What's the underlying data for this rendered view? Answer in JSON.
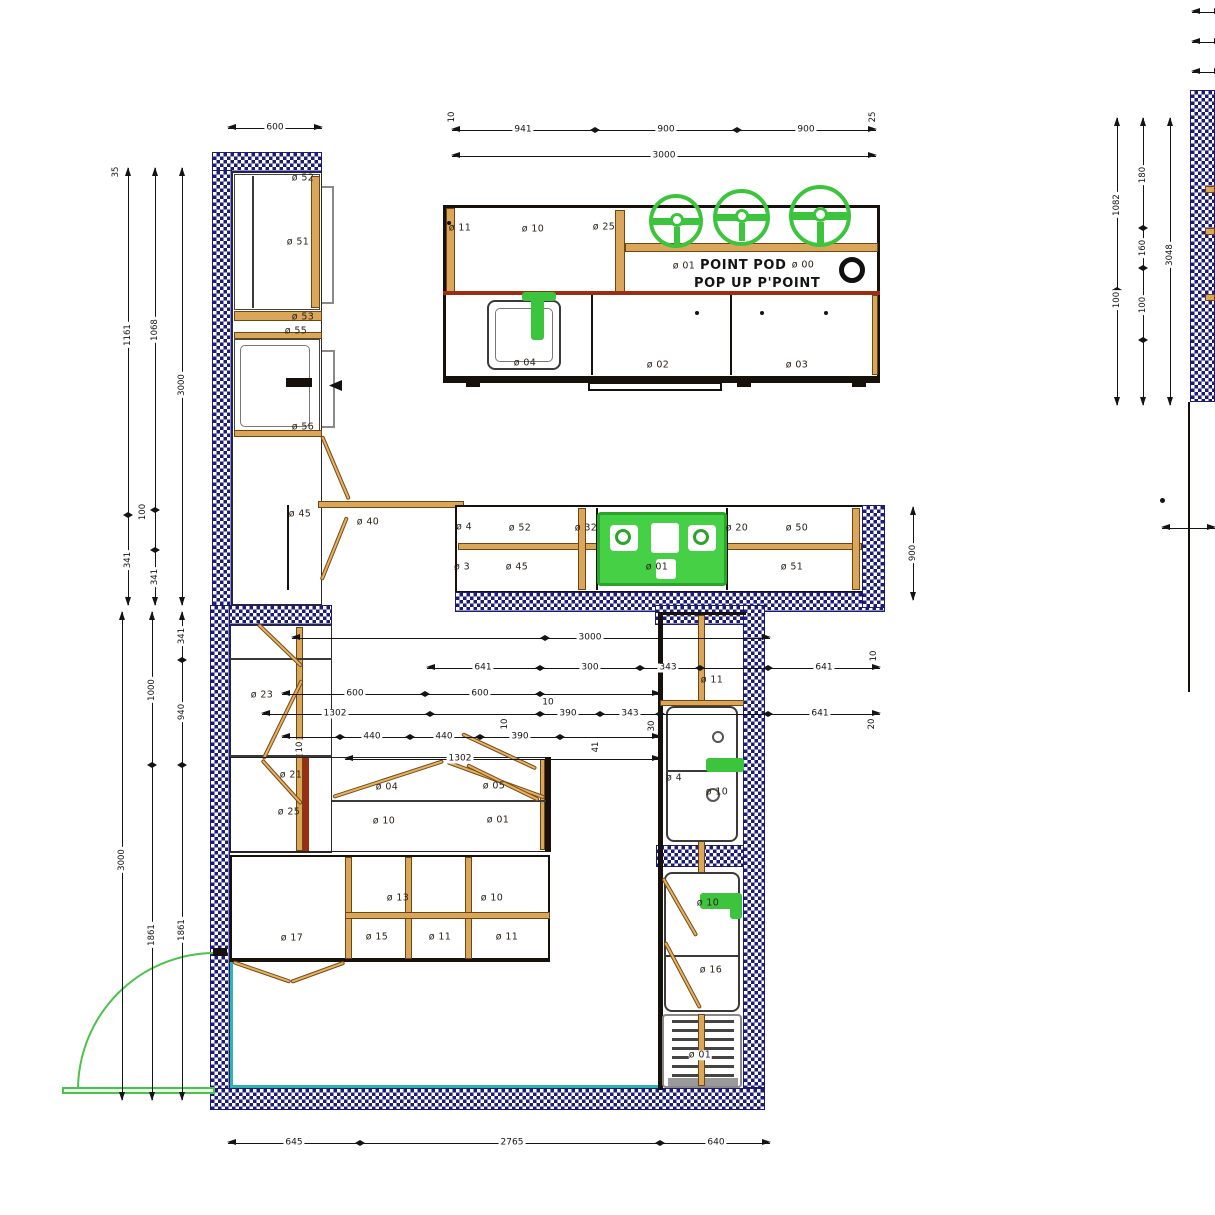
{
  "colors": {
    "wall_navy": "#1c1c78",
    "cabinet_tan": "#d9a65a",
    "outline_dark": "#17110b",
    "counter_red": "#9c2c12",
    "fixture_green": "#3cc43c",
    "door_teal": "#2fb3ae",
    "dim_black": "#141414"
  },
  "top_plan": {
    "dim_seg_left_end": "10",
    "dim_seg_1": "941",
    "dim_seg_2": "900",
    "dim_seg_3": "900",
    "dim_seg_right_end": "25",
    "dim_total": "3000",
    "label_left_edge": "ø 11",
    "label_cabinet": "ø 10",
    "label_divider": "ø 25",
    "text_line1": "POINT POD",
    "text_line2": "POP UP P'POINT",
    "label_outlet_left": "ø 01",
    "label_outlet_right": "ø 00",
    "label_sink": "ø 04",
    "label_base_mid": "ø 02",
    "label_base_right": "ø 03"
  },
  "tall_unit": {
    "dim_width": "600",
    "label_top": "ø 52",
    "label_upper": "ø 51",
    "label_mid1": "ø 53",
    "label_mid2": "ø 55",
    "label_lower": "ø 56"
  },
  "corner": {
    "label_45": "ø 45",
    "label_40": "ø 40"
  },
  "counter_strip": {
    "label_l1": "ø 52",
    "label_l2": "ø 32",
    "label_l3": "ø 45",
    "label_hob": "ø 01",
    "label_r1": "ø 20",
    "label_r2": "ø 50",
    "label_r3": "ø 51",
    "label_edge_top": "ø 4",
    "label_edge_bot": "ø 3",
    "dim_side": "900"
  },
  "lower_plan": {
    "label_tall1": "ø 23",
    "label_tall2": "ø 21",
    "label_tall3": "ø 25",
    "label_counter1": "ø 04",
    "label_counter2": "ø 05",
    "label_counter3": "ø 10",
    "label_counter4": "ø 01",
    "label_base_top1": "ø 13",
    "label_base_top2": "ø 10",
    "label_base1": "ø 17",
    "label_base2": "ø 15",
    "label_base3": "ø 11",
    "label_base4": "ø 11",
    "label_right_top": "ø 11",
    "label_right_sink_a": "ø 4",
    "label_right_sink_b": "ø 10",
    "label_right_tap": "ø 10",
    "label_right_mid": "ø 16",
    "label_right_grille": "ø 01"
  },
  "mid_dims": {
    "row_a": "3000",
    "row_b1": "641",
    "row_b2": "300",
    "row_b3": "343",
    "row_b4": "641",
    "row_b5": "10",
    "row_c1": "600",
    "row_c2": "600",
    "row_c3": "10",
    "row_d1": "1302",
    "row_d2": "390",
    "row_d3": "343",
    "row_d4": "641",
    "row_d5": "10",
    "row_d6": "30",
    "row_d7": "20",
    "row_e1": "440",
    "row_e2": "440",
    "row_e3": "390",
    "row_e4": "10",
    "row_e5": "41",
    "row_f1": "1302"
  },
  "bottom_dims": {
    "seg1": "645",
    "seg2": "2765",
    "seg3": "640"
  },
  "left_dims_upper": {
    "c1_a": "1161",
    "c1_b": "341",
    "c2_a": "1068",
    "c2_b": "100",
    "c2_c": "341",
    "c3_total": "3000",
    "top_tick": "35"
  },
  "left_dims_lower": {
    "c1_total": "3000",
    "c2_a": "1000",
    "c2_b": "1861",
    "c3_a": "341",
    "c3_b": "940",
    "c3_c": "1861"
  },
  "right_sheet": {
    "c1_a": "1082",
    "c1_b": "100",
    "c2_a": "180",
    "c2_b": "160",
    "c2_c": "100",
    "c3_total": "3048"
  }
}
